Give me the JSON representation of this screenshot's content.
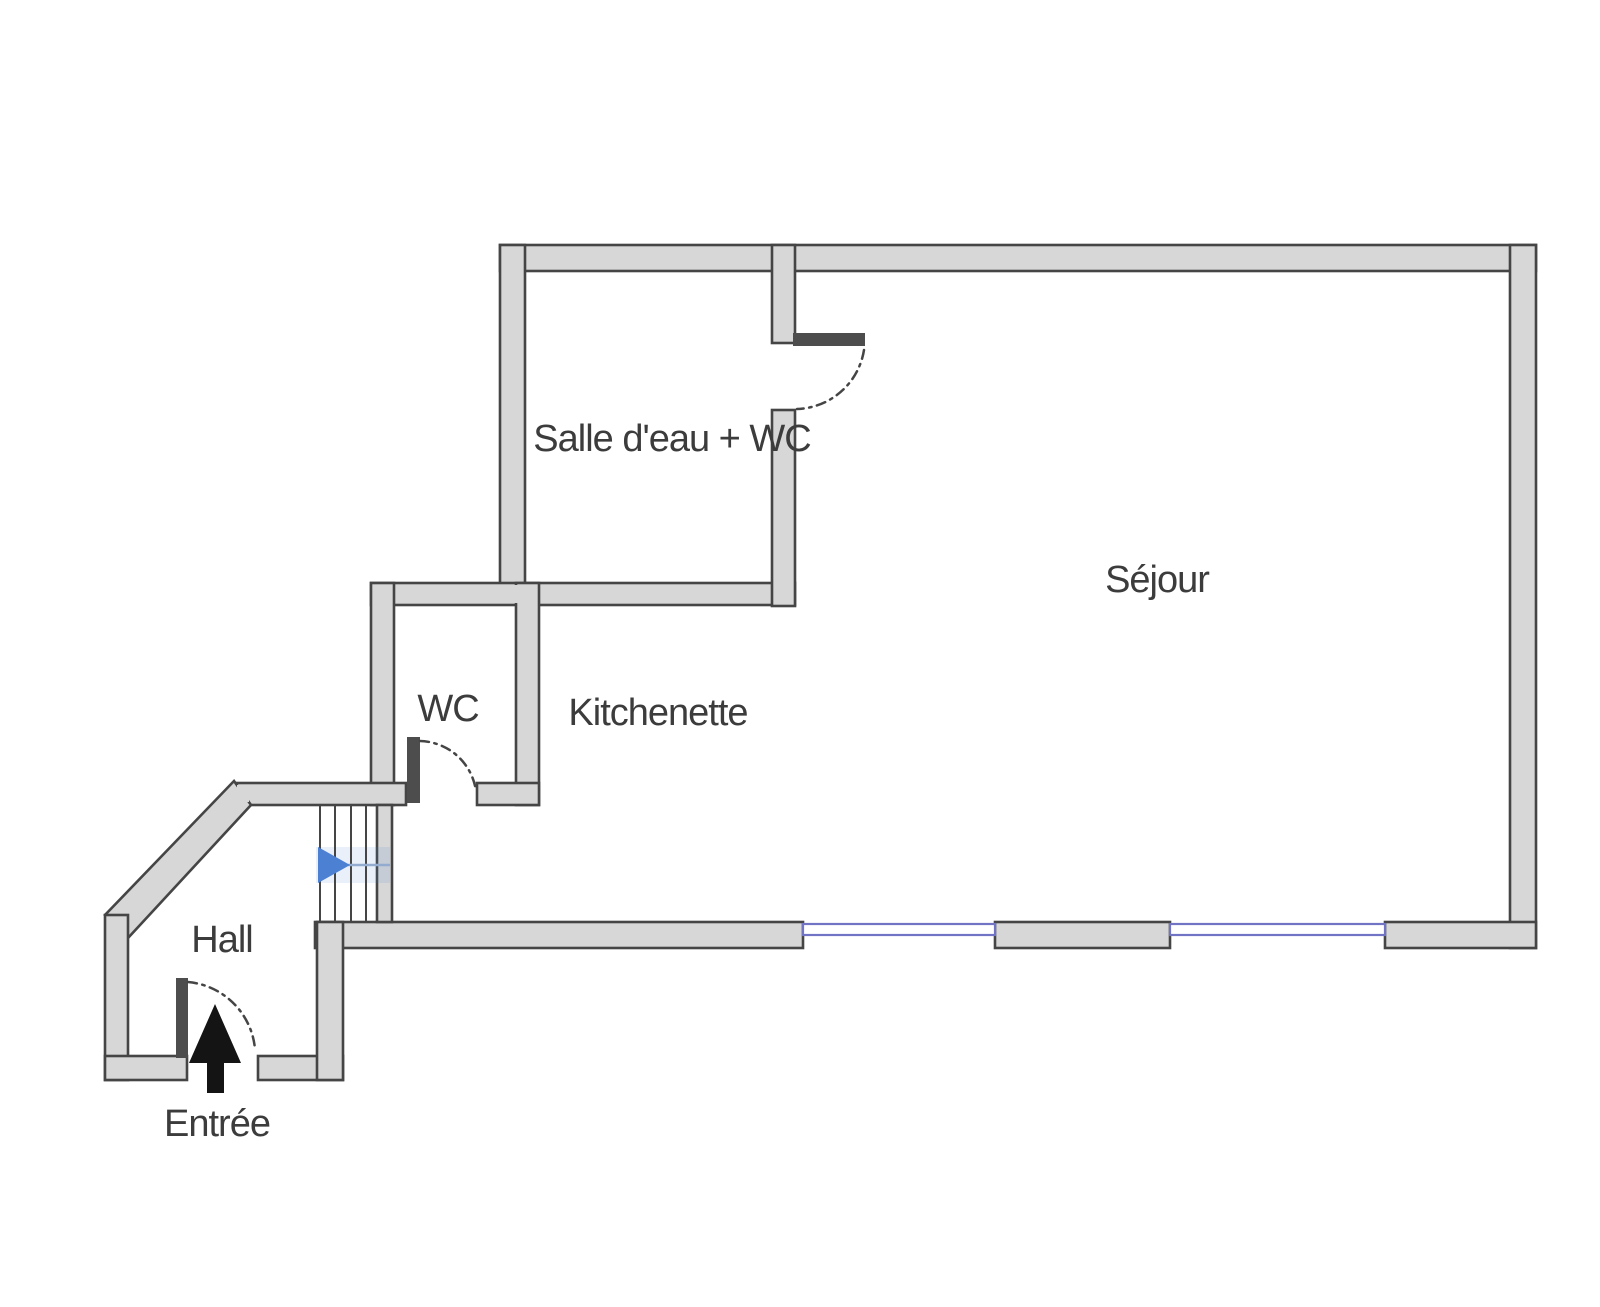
{
  "plan": {
    "rooms": {
      "salle_deau": {
        "label": "Salle d'eau + WC"
      },
      "sejour": {
        "label": "Séjour"
      },
      "wc": {
        "label": "WC"
      },
      "kitchenette": {
        "label": "Kitchenette"
      },
      "hall": {
        "label": "Hall"
      },
      "entree": {
        "label": "Entrée"
      }
    },
    "icons": {
      "entry_arrow": "up-arrow",
      "stair_direction_arrow": "right-arrow"
    },
    "colors": {
      "background": "#ffffff",
      "wall_fill": "#d7d7d7",
      "wall_edge": "#454545",
      "door_leaf": "#4d4d4d",
      "window_blue": "#7173c4",
      "stair_arrow_blue": "#4c80d2",
      "stair_line_blue": "#93abce",
      "entry_arrow": "#141414",
      "text": "#3c3c3c"
    }
  }
}
